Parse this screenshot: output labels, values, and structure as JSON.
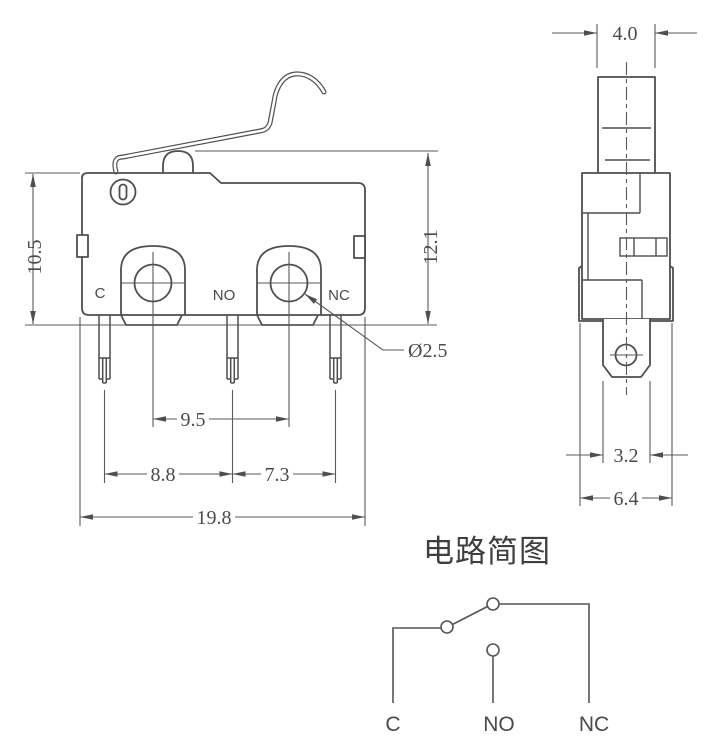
{
  "drawing": {
    "colors": {
      "line": "#4e4e4e",
      "dimension_line": "#5a5a5a",
      "background": "#ffffff"
    },
    "front_view": {
      "labels": {
        "c": "C",
        "no": "NO",
        "nc": "NC"
      },
      "dimensions": {
        "body_height": "10.5",
        "total_height": "12.1",
        "mount_hole_spacing": "9.5",
        "pin_pitch_left": "8.8",
        "pin_pitch_right": "7.3",
        "body_width": "19.8",
        "mount_hole_diameter": "Ø2.5"
      }
    },
    "side_view": {
      "dimensions": {
        "plunger_width": "4.0",
        "terminal_width": "3.2",
        "body_thickness": "6.4"
      }
    },
    "circuit_diagram": {
      "title": "电路简图",
      "labels": {
        "c": "C",
        "no": "NO",
        "nc": "NC"
      }
    }
  }
}
